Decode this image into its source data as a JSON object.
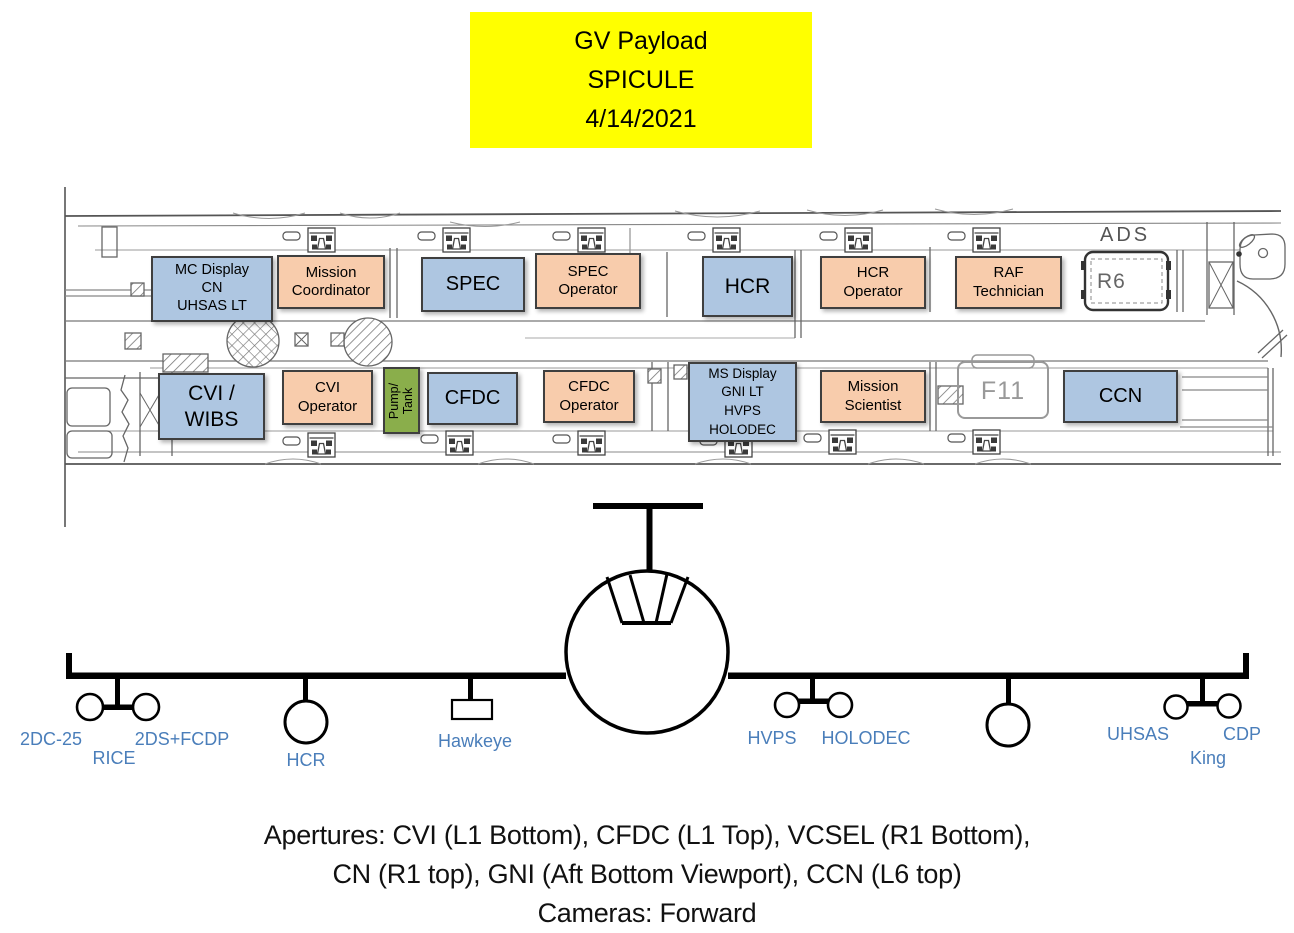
{
  "title": {
    "line1": "GV Payload",
    "line2": "SPICULE",
    "line3": "4/14/2021"
  },
  "colors": {
    "title_bg": "#FFFF00",
    "box_blue": "#AEC6E1",
    "box_peach": "#F8CCAC",
    "box_green": "#8AAE4B",
    "box_border": "#3F3F3F",
    "wing_label_blue": "#4A7EBA"
  },
  "floor_plan": {
    "annotations": {
      "ads": "ADS",
      "r6": "R6",
      "f11": "F11"
    },
    "boxes": {
      "mc_display": {
        "l1": "MC Display",
        "l2": "CN",
        "l3": "UHSAS LT"
      },
      "mission_coordinator": {
        "l1": "Mission",
        "l2": "Coordinator"
      },
      "spec": {
        "l1": "SPEC"
      },
      "spec_operator": {
        "l1": "SPEC",
        "l2": "Operator"
      },
      "hcr": {
        "l1": "HCR"
      },
      "hcr_operator": {
        "l1": "HCR",
        "l2": "Operator"
      },
      "raf_technician": {
        "l1": "RAF",
        "l2": "Technician"
      },
      "cvi_wibs": {
        "l1": "CVI /",
        "l2": "WIBS"
      },
      "cvi_operator": {
        "l1": "CVI",
        "l2": "Operator"
      },
      "pump_tank": {
        "l1": "Pump/",
        "l2": "Tank"
      },
      "cfdc": {
        "l1": "CFDC"
      },
      "cfdc_operator": {
        "l1": "CFDC",
        "l2": "Operator"
      },
      "ms_display": {
        "l1": "MS Display",
        "l2": "GNI LT",
        "l3": "HVPS",
        "l4": "HOLODEC"
      },
      "mission_scientist": {
        "l1": "Mission",
        "l2": "Scientist"
      },
      "ccn": {
        "l1": "CCN"
      }
    }
  },
  "front_view": {
    "labels": {
      "p2dc25": "2DC-25",
      "rice": "RICE",
      "fcdp": "2DS+FCDP",
      "hcr": "HCR",
      "hawkeye": "Hawkeye",
      "hvps": "HVPS",
      "holodec": "HOLODEC",
      "uhsas": "UHSAS",
      "king": "King",
      "cdp": "CDP"
    }
  },
  "footer": {
    "line1": "Apertures: CVI (L1 Bottom), CFDC (L1 Top), VCSEL (R1 Bottom),",
    "line2": "CN (R1 top), GNI (Aft Bottom Viewport), CCN (L6 top)",
    "line3": "Cameras: Forward"
  }
}
